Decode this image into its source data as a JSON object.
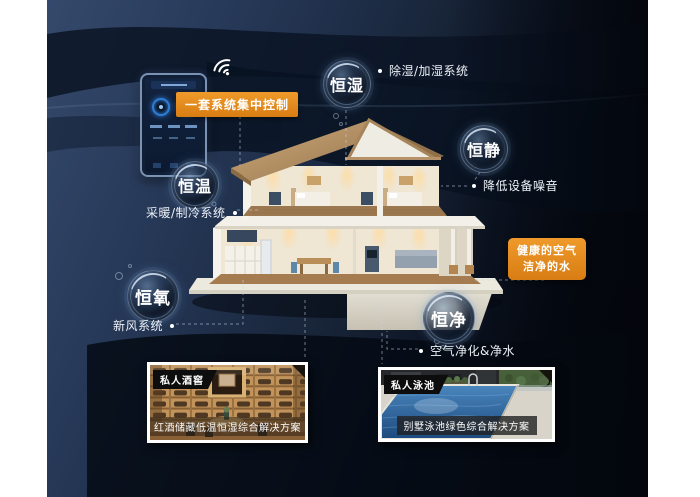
{
  "poster": {
    "control": {
      "label": "一套系统集中控制"
    },
    "callouts": {
      "humidity": {
        "bubble": "恒湿",
        "label": "除湿/加湿系统"
      },
      "quiet": {
        "bubble": "恒静",
        "label": "降低设备噪音"
      },
      "temperature": {
        "bubble": "恒温",
        "label": "采暖/制冷系统"
      },
      "oxygen": {
        "bubble": "恒氧",
        "label": "新风系统"
      },
      "purity": {
        "bubble": "恒净",
        "label": "空气净化&净水"
      }
    },
    "highlight": {
      "line1": "健康的空气",
      "line2": "洁净的水"
    },
    "cards": [
      {
        "tag": "私人酒窖",
        "caption": "红酒储藏低温恒湿综合解决方案"
      },
      {
        "tag": "私人泳池",
        "caption": "别墅泳池绿色综合解决方案"
      }
    ],
    "icons": {
      "wifi": "wifi-icon",
      "phone": "smart-home-controller-phone"
    },
    "colors": {
      "accent_orange": "#E1861B",
      "background_navy": "#2C3E5C",
      "dark_band": "#0A1322",
      "bubble_text": "#FFFFFF",
      "pool_blue": "#2F6FA8",
      "wine_wood": "#C0985F"
    }
  }
}
